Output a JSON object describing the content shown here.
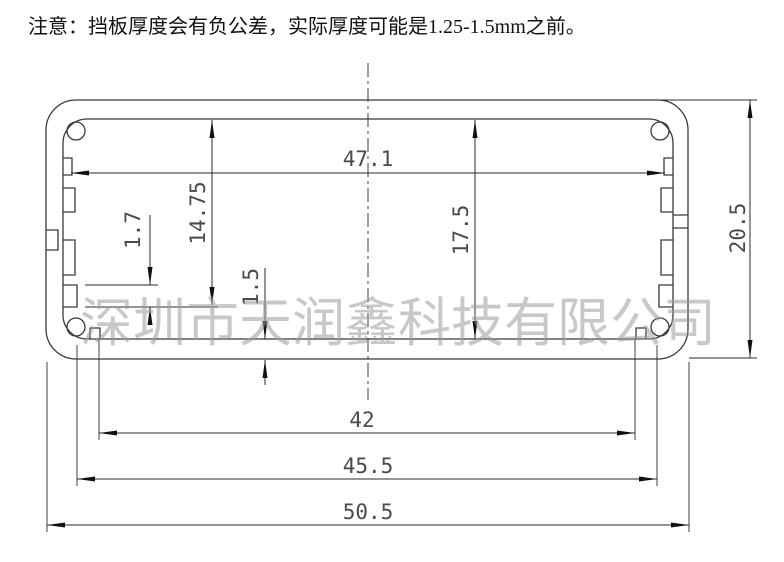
{
  "note": "注意：挡板厚度会有负公差，实际厚度可能是1.25-1.5mm之前。",
  "watermark": "深圳市天润鑫科技有限公司",
  "drawing": {
    "type": "extrusion-profile-cross-section",
    "units": "mm",
    "dims": {
      "inner_width_top": "47.1",
      "slot_height": "14.75",
      "step_small": "1.7",
      "inner_height": "17.5",
      "bottom_wall": "1.5",
      "overall_height": "20.5",
      "inner_width_bottom": "42",
      "groove_span": "45.5",
      "overall_width": "50.5"
    },
    "colors": {
      "line": "#3a3a3a",
      "dimension": "#2b2b2b",
      "text": "#4a4a4a",
      "watermark": "#9b9b9b"
    }
  }
}
